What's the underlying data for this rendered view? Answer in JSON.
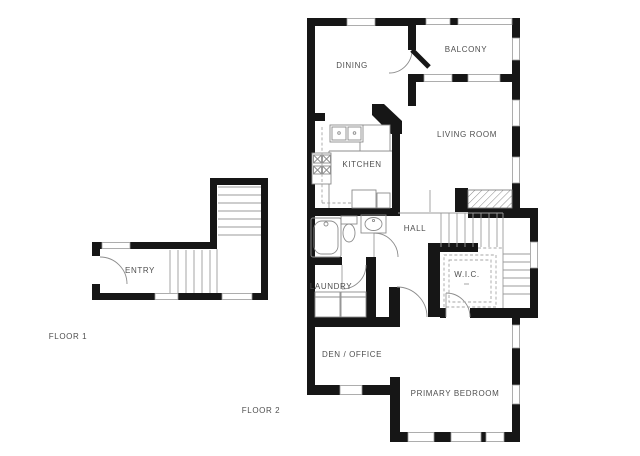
{
  "document": {
    "type": "floor-plan",
    "background": "#ffffff"
  },
  "colors": {
    "wall": "#161616",
    "thin_line": "#9b9b9b",
    "label_text": "#4f4f4f",
    "window_line": "#999999"
  },
  "floor1": {
    "label": "FLOOR 1",
    "rooms": {
      "entry": "ENTRY"
    }
  },
  "floor2": {
    "label": "FLOOR 2",
    "rooms": {
      "dining": "DINING",
      "balcony": "BALCONY",
      "living_room": "LIVING ROOM",
      "kitchen": "KITCHEN",
      "hall": "HALL",
      "wic": "W.I.C.",
      "laundry": "LAUNDRY",
      "den_office": "DEN / OFFICE",
      "primary_bedroom": "PRIMARY BEDROOM"
    }
  }
}
